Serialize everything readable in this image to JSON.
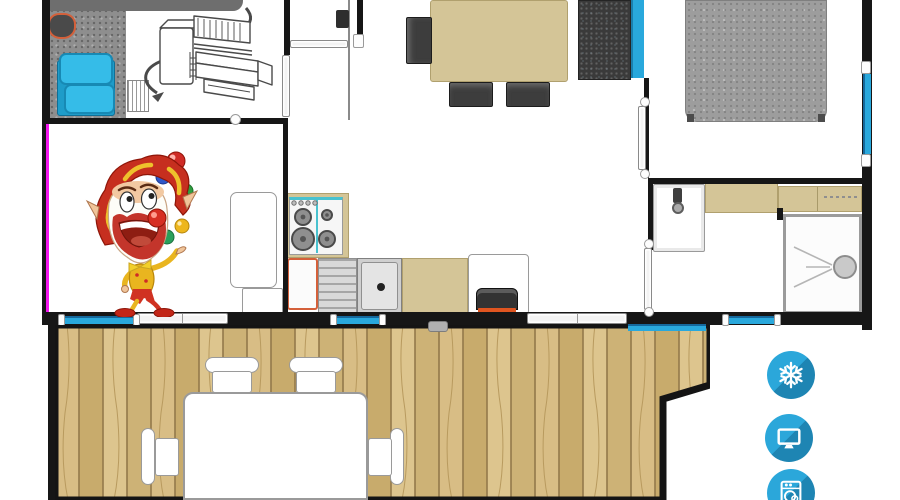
{
  "title": "Mobile home floor plan with terrace",
  "palette": {
    "wall": "#161616",
    "accent_magenta": "#f216ee",
    "window_blue": "#29a8dc",
    "window_blue_dark": "#15689c",
    "pillow_blue": "#35bce8",
    "furniture_tan": "#d4c597",
    "furniture_tan_border": "#b0a06e",
    "charcoal": "#3a3a3a",
    "bed_gray": "#9d9d9d",
    "carpet_gray": "#8e8e8e",
    "band_gray": "#6e6e6e",
    "orange_accent": "#d4603a",
    "icon_blue": "#2ba7da",
    "icon_blue_dark": "#1e85b3"
  },
  "rooms": [
    {
      "id": "kids-bedroom",
      "label": "Kids bedroom with bunk bed"
    },
    {
      "id": "living-dining",
      "label": "Living / dining area"
    },
    {
      "id": "kitchen",
      "label": "Kitchen"
    },
    {
      "id": "master-bedroom",
      "label": "Master bedroom"
    },
    {
      "id": "bathroom",
      "label": "Bathroom with shower"
    },
    {
      "id": "terrace",
      "label": "Wooden terrace deck"
    }
  ],
  "furniture": [
    {
      "id": "bunk-bed-sketch",
      "label": "Bunk bed 3D sketch"
    },
    {
      "id": "blue-bed",
      "label": "Bed with blue pillows"
    },
    {
      "id": "dining-table",
      "label": "Dining table with chairs"
    },
    {
      "id": "sofa",
      "label": "Sofa with blue cushion"
    },
    {
      "id": "double-bed",
      "label": "Double bed"
    },
    {
      "id": "gas-hob",
      "label": "4-burner gas hob"
    },
    {
      "id": "kitchen-sink",
      "label": "Kitchen sink and drainer"
    },
    {
      "id": "fridge",
      "label": "Fridge"
    },
    {
      "id": "washbasin",
      "label": "Washbasin"
    },
    {
      "id": "shower",
      "label": "Shower cubicle"
    },
    {
      "id": "deck-table",
      "label": "Terrace table with four chairs"
    }
  ],
  "amenities": [
    {
      "id": "air-conditioning",
      "label": "Air conditioning",
      "glyph": "snowflake-icon"
    },
    {
      "id": "tv",
      "label": "Television",
      "glyph": "tv-icon"
    },
    {
      "id": "washing-machine",
      "label": "Washing machine",
      "glyph": "washing-machine-icon"
    }
  ],
  "illustration": {
    "label": "Juggling clown mascot"
  }
}
